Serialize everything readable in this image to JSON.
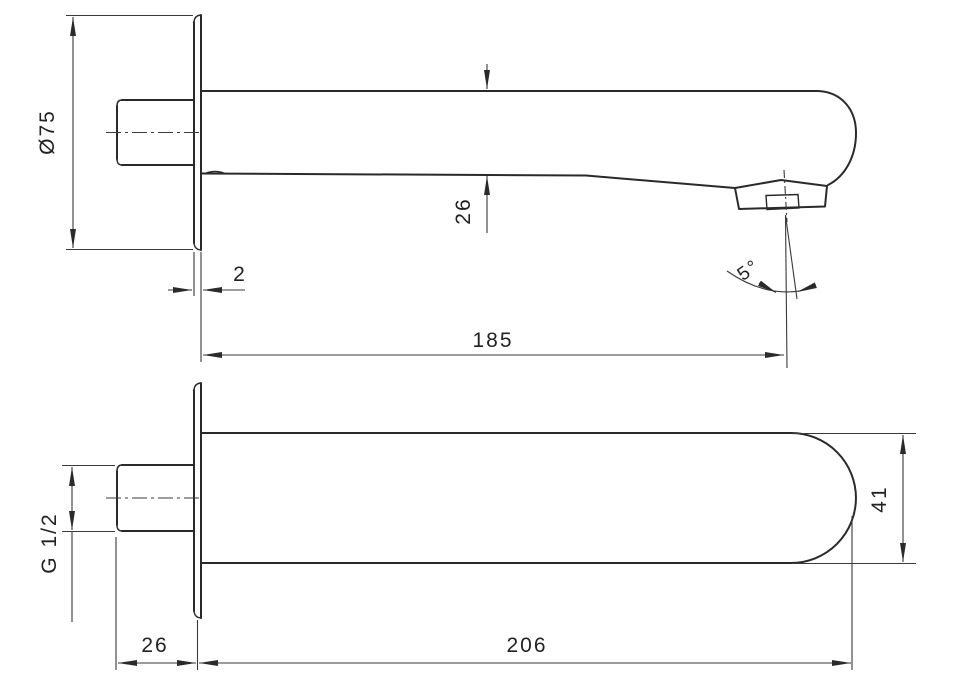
{
  "drawing": {
    "type": "technical-orthographic-drawing",
    "subject": "wall-mounted spout",
    "colors": {
      "line": "#2a2a2a",
      "background": "#ffffff"
    },
    "front_view": {
      "labels": {
        "flange_diameter": "Ø75",
        "plate_thickness": "2",
        "spout_height": "26",
        "spout_length": "185",
        "outlet_angle": "5°"
      }
    },
    "bottom_view": {
      "labels": {
        "thread_size": "G 1/2",
        "thread_length": "26",
        "total_length": "206",
        "spout_width": "41"
      }
    }
  }
}
